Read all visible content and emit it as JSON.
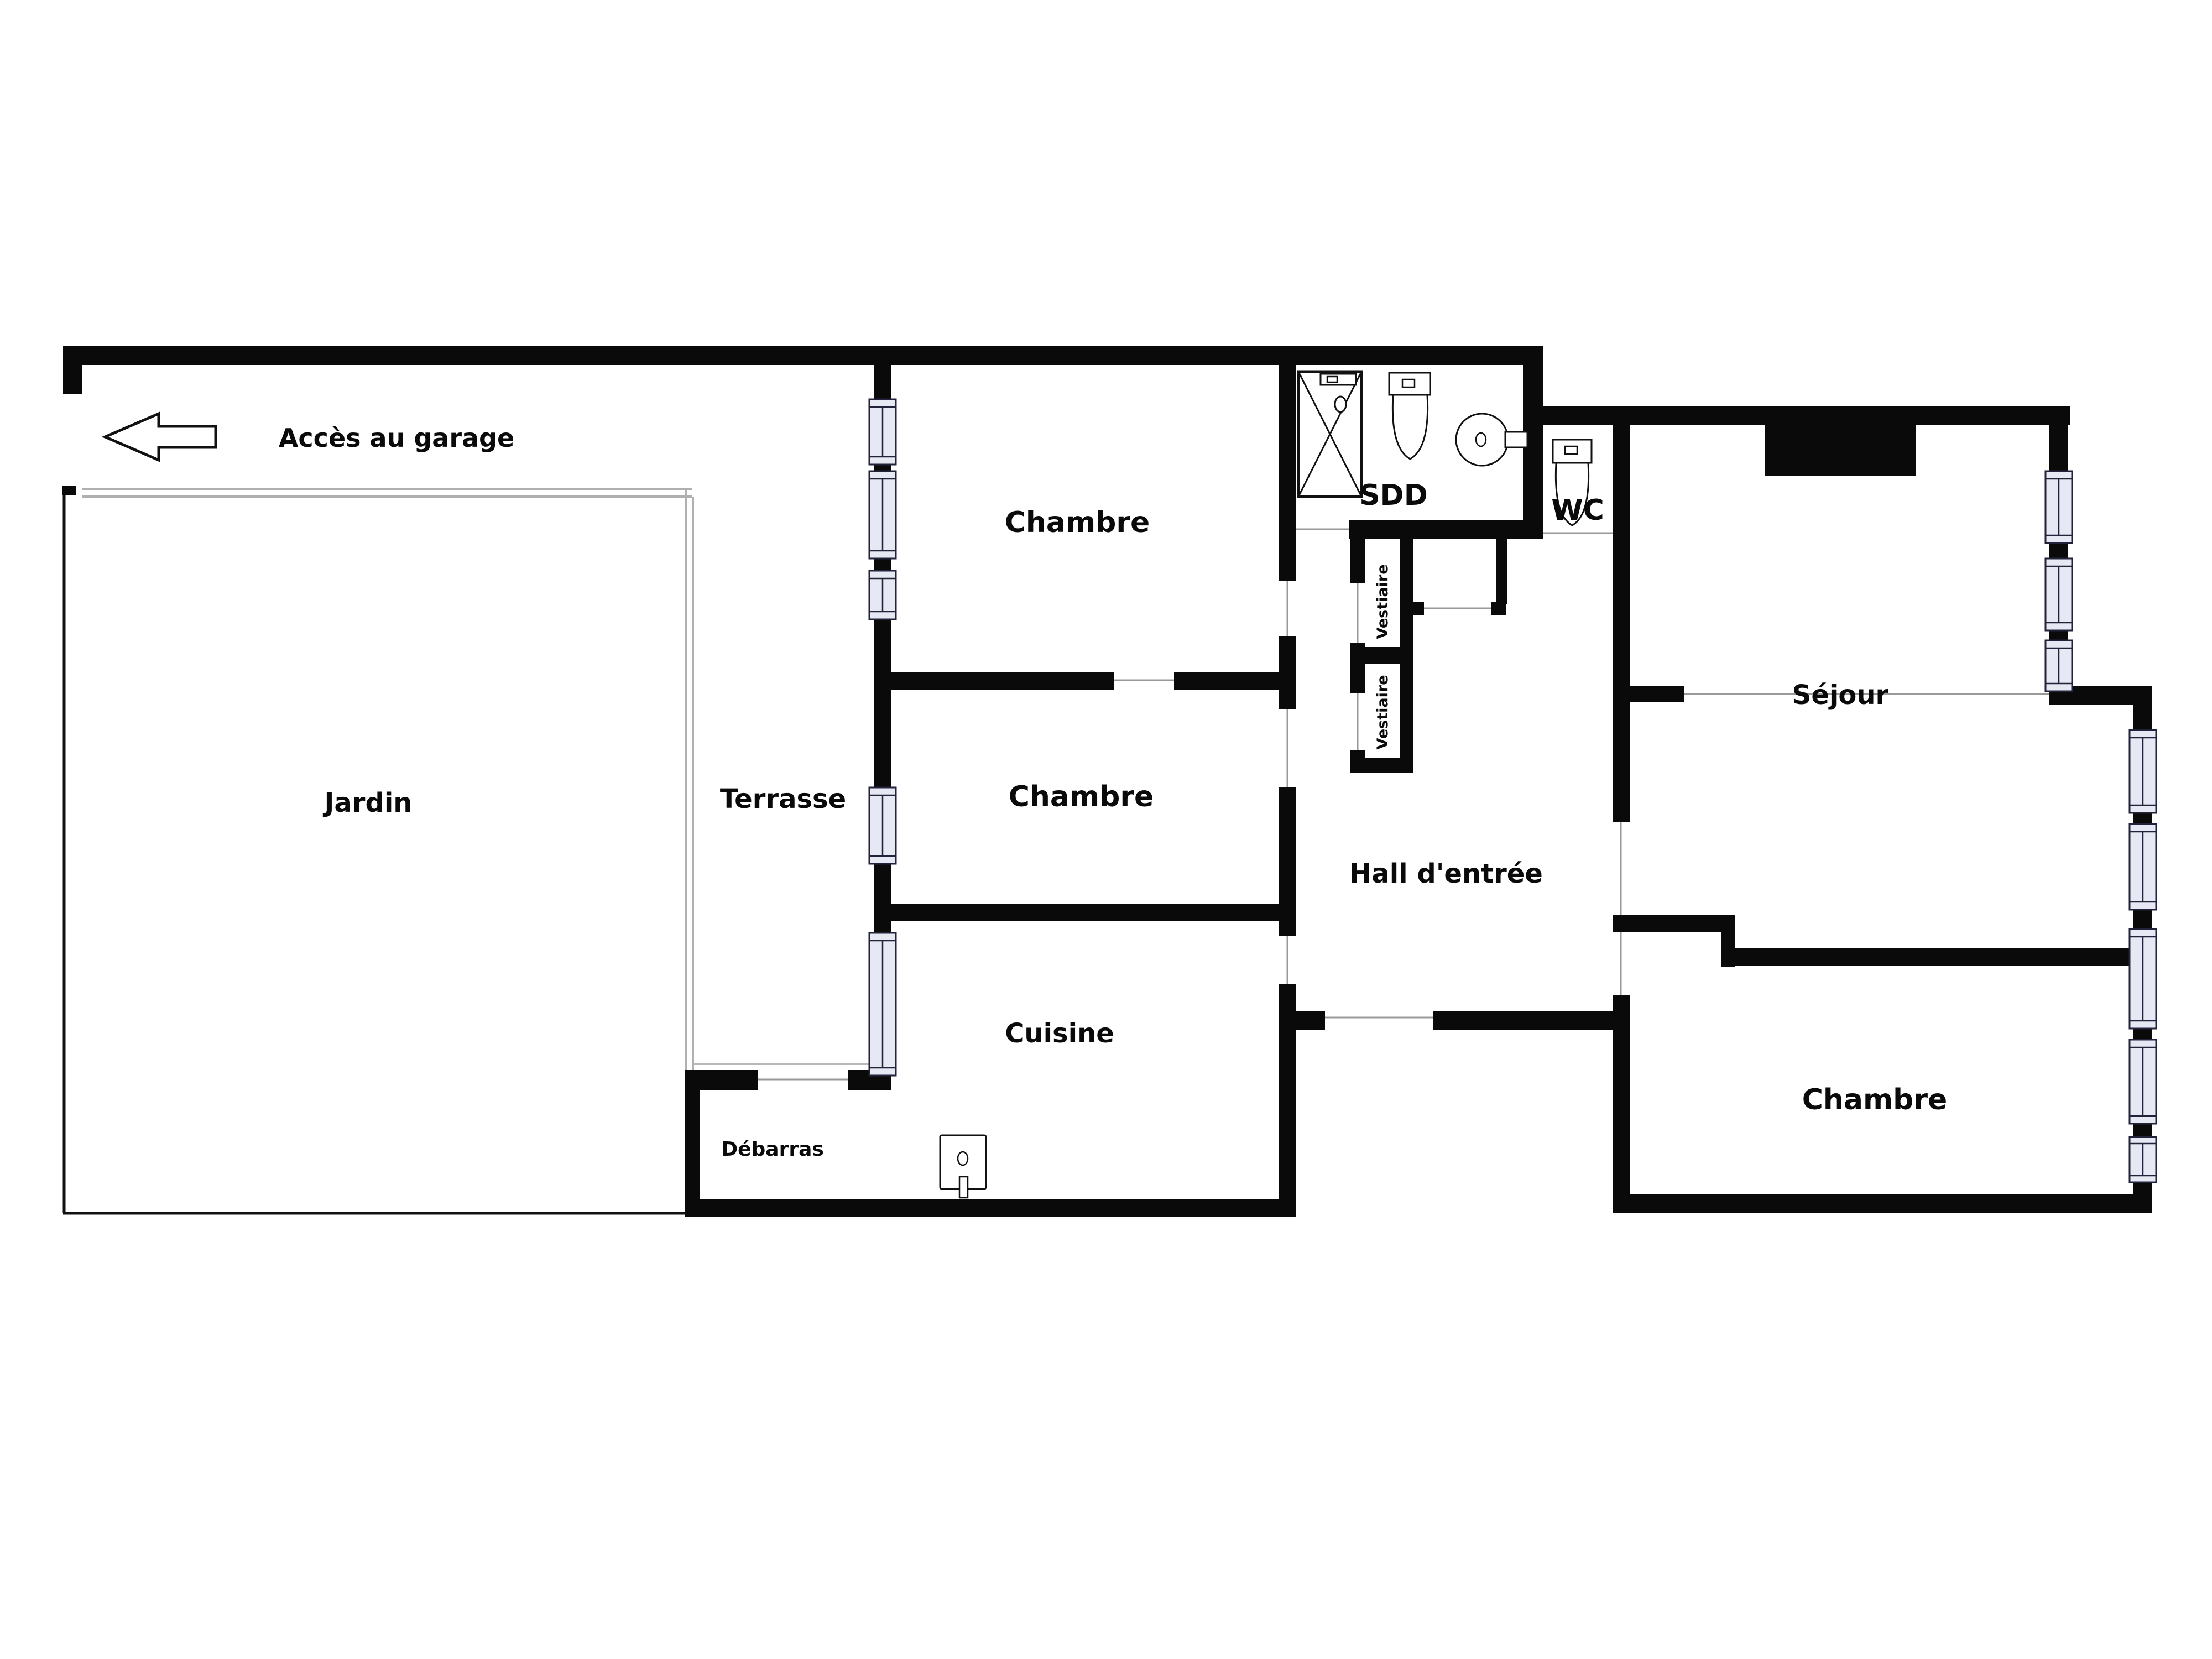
{
  "plan": {
    "labels": {
      "acces_garage": "Accès au garage",
      "jardin": "Jardin",
      "terrasse": "Terrasse",
      "chambre_1": "Chambre",
      "chambre_2": "Chambre",
      "chambre_3": "Chambre",
      "cuisine": "Cuisine",
      "sdd": "SDD",
      "wc": "WC",
      "vestiaire_1": "Vestiaire",
      "vestiaire_2": "Vestiaire",
      "hall": "Hall d'entrée",
      "sejour": "Séjour",
      "debarras": "Débarras"
    },
    "colors": {
      "wall": "#0a0a0a",
      "window_fill": "#e6e8f3",
      "window_frame": "#22223a",
      "opening_line": "#999999",
      "garden_line": "#b0b0b0",
      "background": "#ffffff",
      "text": "#0a0a0a"
    },
    "icons": [
      "garage-arrow-icon",
      "shower-icon",
      "toilet-icon",
      "round-basin-icon",
      "kitchen-sink-icon"
    ]
  }
}
